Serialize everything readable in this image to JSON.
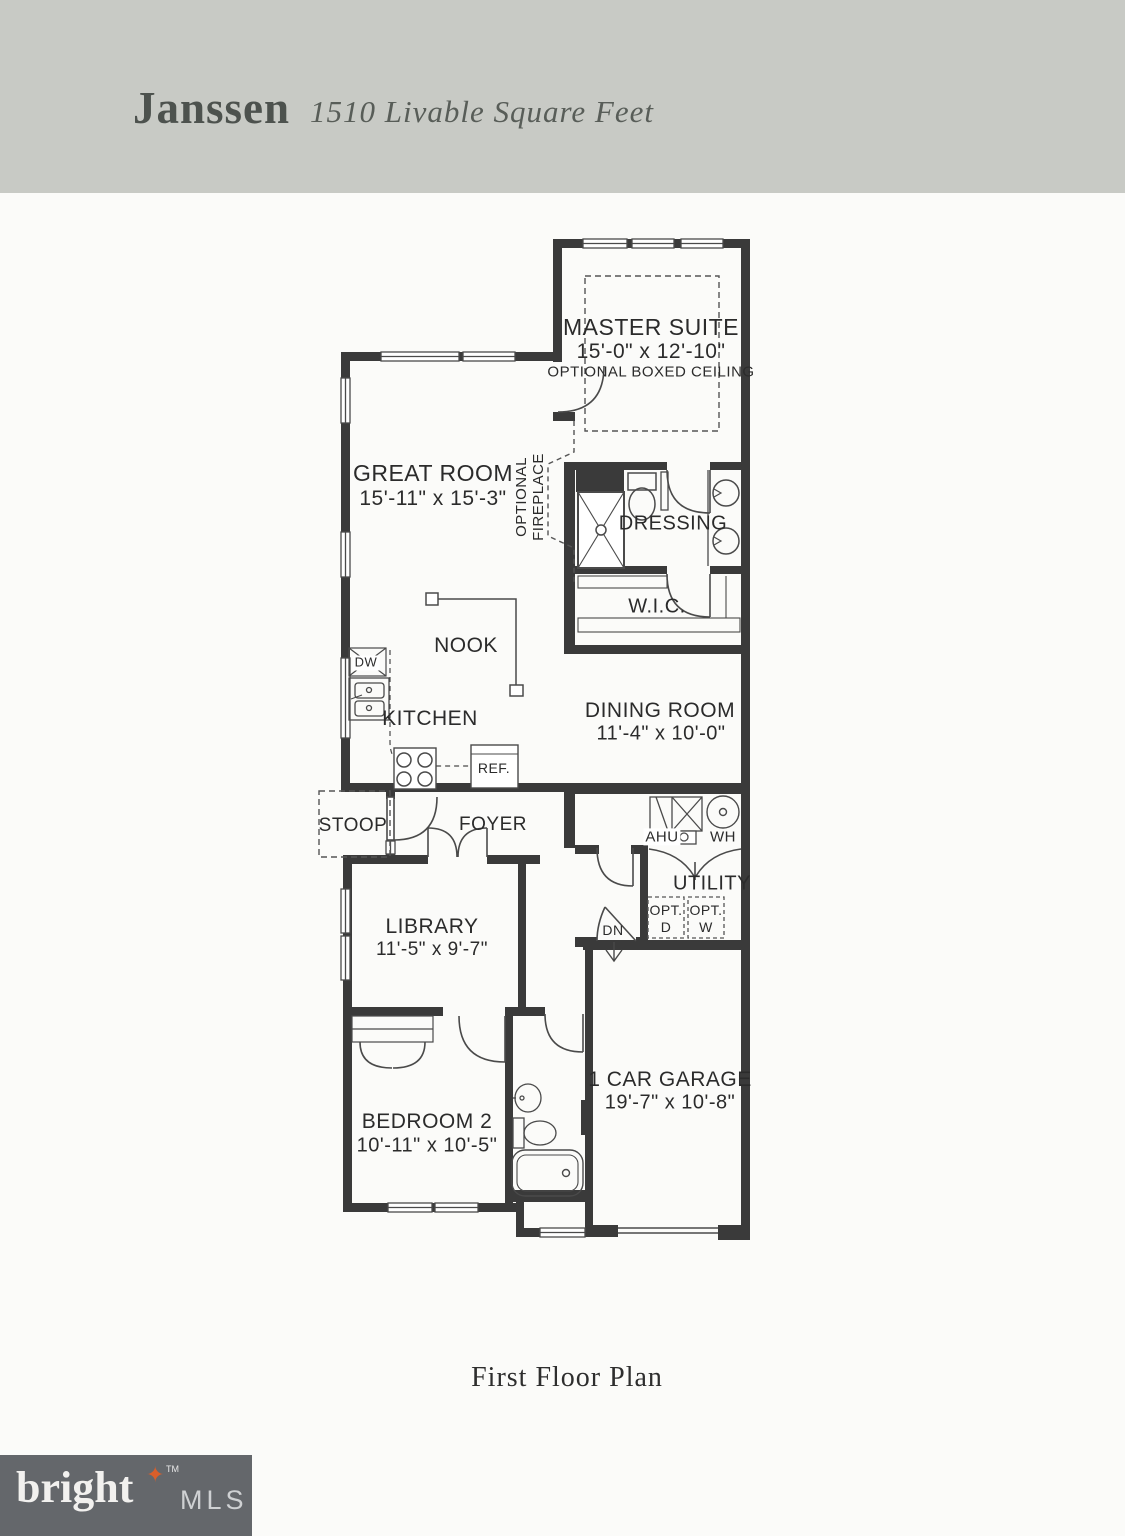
{
  "header": {
    "title": "Janssen",
    "subtitle": "1510 Livable Square Feet"
  },
  "plan": {
    "master_suite_name": "MASTER SUITE",
    "master_suite_dims": "15'-0\" x 12'-10\"",
    "master_suite_note": "OPTIONAL BOXED CEILING",
    "great_room_name": "GREAT ROOM",
    "great_room_dims": "15'-11\" x 15'-3\"",
    "optional_fireplace_line1": "OPTIONAL",
    "optional_fireplace_line2": "FIREPLACE",
    "dressing_name": "DRESSING",
    "wic_name": "W.I.C.",
    "nook_name": "NOOK",
    "kitchen_name": "KITCHEN",
    "dw_label": "DW",
    "ref_label": "REF.",
    "dining_room_name": "DINING ROOM",
    "dining_room_dims": "11'-4\" x 10'-0\"",
    "stoop_name": "STOOP",
    "foyer_name": "FOYER",
    "library_name": "LIBRARY",
    "library_dims": "11'-5\" x 9'-7\"",
    "utility_name": "UTILITY",
    "ahu_label": "AHU",
    "wh_label": "WH",
    "dn_label": "DN",
    "opt_dryer_line1": "OPT.",
    "opt_dryer_line2": "D",
    "opt_washer_line1": "OPT.",
    "opt_washer_line2": "W",
    "bedroom2_name": "BEDROOM 2",
    "bedroom2_dims": "10'-11\" x 10'-5\"",
    "garage_name": "1 CAR GARAGE",
    "garage_dims": "19'-7\" x 10'-8\""
  },
  "caption": "First Floor Plan",
  "logo": {
    "brand": "brigh",
    "t_glyph": "t",
    "star": "✦",
    "tm": "TM",
    "suffix": "MLS"
  },
  "colors": {
    "header_band": "#c8cac5",
    "wall": "#3a3a3a",
    "line": "#4a4a4a",
    "paper": "#fbfbf9",
    "logo_bg": "#64676b",
    "logo_star": "#d95f2b"
  }
}
